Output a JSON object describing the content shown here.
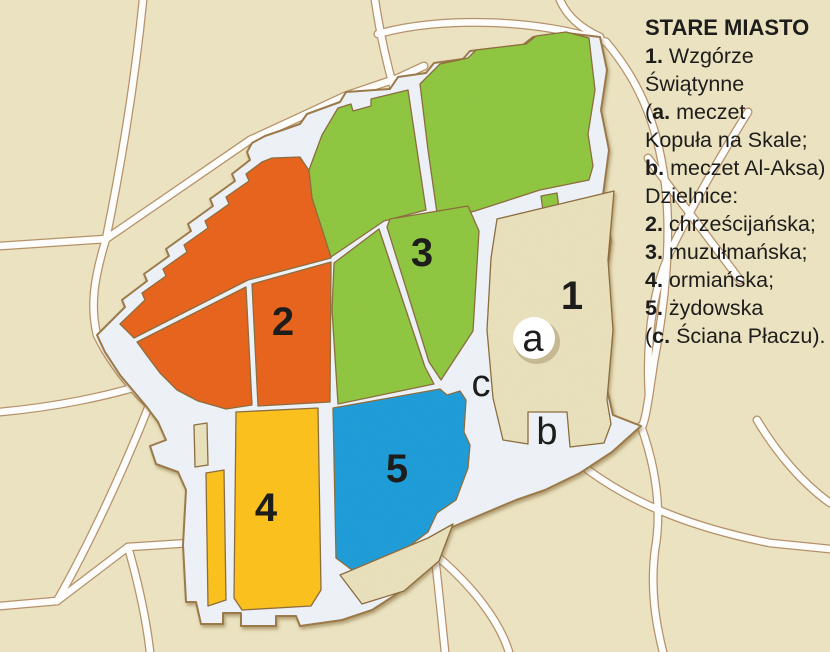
{
  "colors": {
    "background": "#ece4c2",
    "road_fill": "#ffffff",
    "road_casing": "#b5916a",
    "wall_fill": "#eef3fa",
    "inner_beige": "#e9e1bd",
    "quarter_2_christian": "#e8631c",
    "quarter_3_muslim": "#8ec63f",
    "quarter_4_armenian": "#fcc11d",
    "quarter_5_jewish": "#1f9cd9",
    "label_text": "#1d1d1b"
  },
  "legend": {
    "title": "STARE MIASTO",
    "lines": [
      [
        {
          "b": "1."
        },
        {
          "t": " Wzgórze"
        }
      ],
      [
        {
          "t": "Świątynne"
        }
      ],
      [
        {
          "t": "("
        },
        {
          "b": "a."
        },
        {
          "t": " meczet"
        }
      ],
      [
        {
          "t": "Kopuła na Skale;"
        }
      ],
      [
        {
          "b": "b."
        },
        {
          "t": " meczet Al-Aksa)"
        }
      ],
      [
        {
          "t": "Dzielnice:"
        }
      ],
      [
        {
          "b": "2."
        },
        {
          "t": " chrześcijańska;"
        }
      ],
      [
        {
          "b": "3."
        },
        {
          "t": " muzułmańska;"
        }
      ],
      [
        {
          "b": "4."
        },
        {
          "t": " ormiańska;"
        }
      ],
      [
        {
          "b": "5."
        },
        {
          "t": " żydowska"
        }
      ],
      [
        {
          "t": "("
        },
        {
          "b": "c."
        },
        {
          "t": " Ściana Płaczu)."
        }
      ]
    ]
  },
  "map": {
    "district_labels": [
      {
        "text": "1"
      },
      {
        "text": "2"
      },
      {
        "text": "3"
      },
      {
        "text": "4"
      },
      {
        "text": "5"
      }
    ],
    "poi_labels": [
      {
        "text": "a"
      },
      {
        "text": "b"
      },
      {
        "text": "c"
      }
    ]
  }
}
